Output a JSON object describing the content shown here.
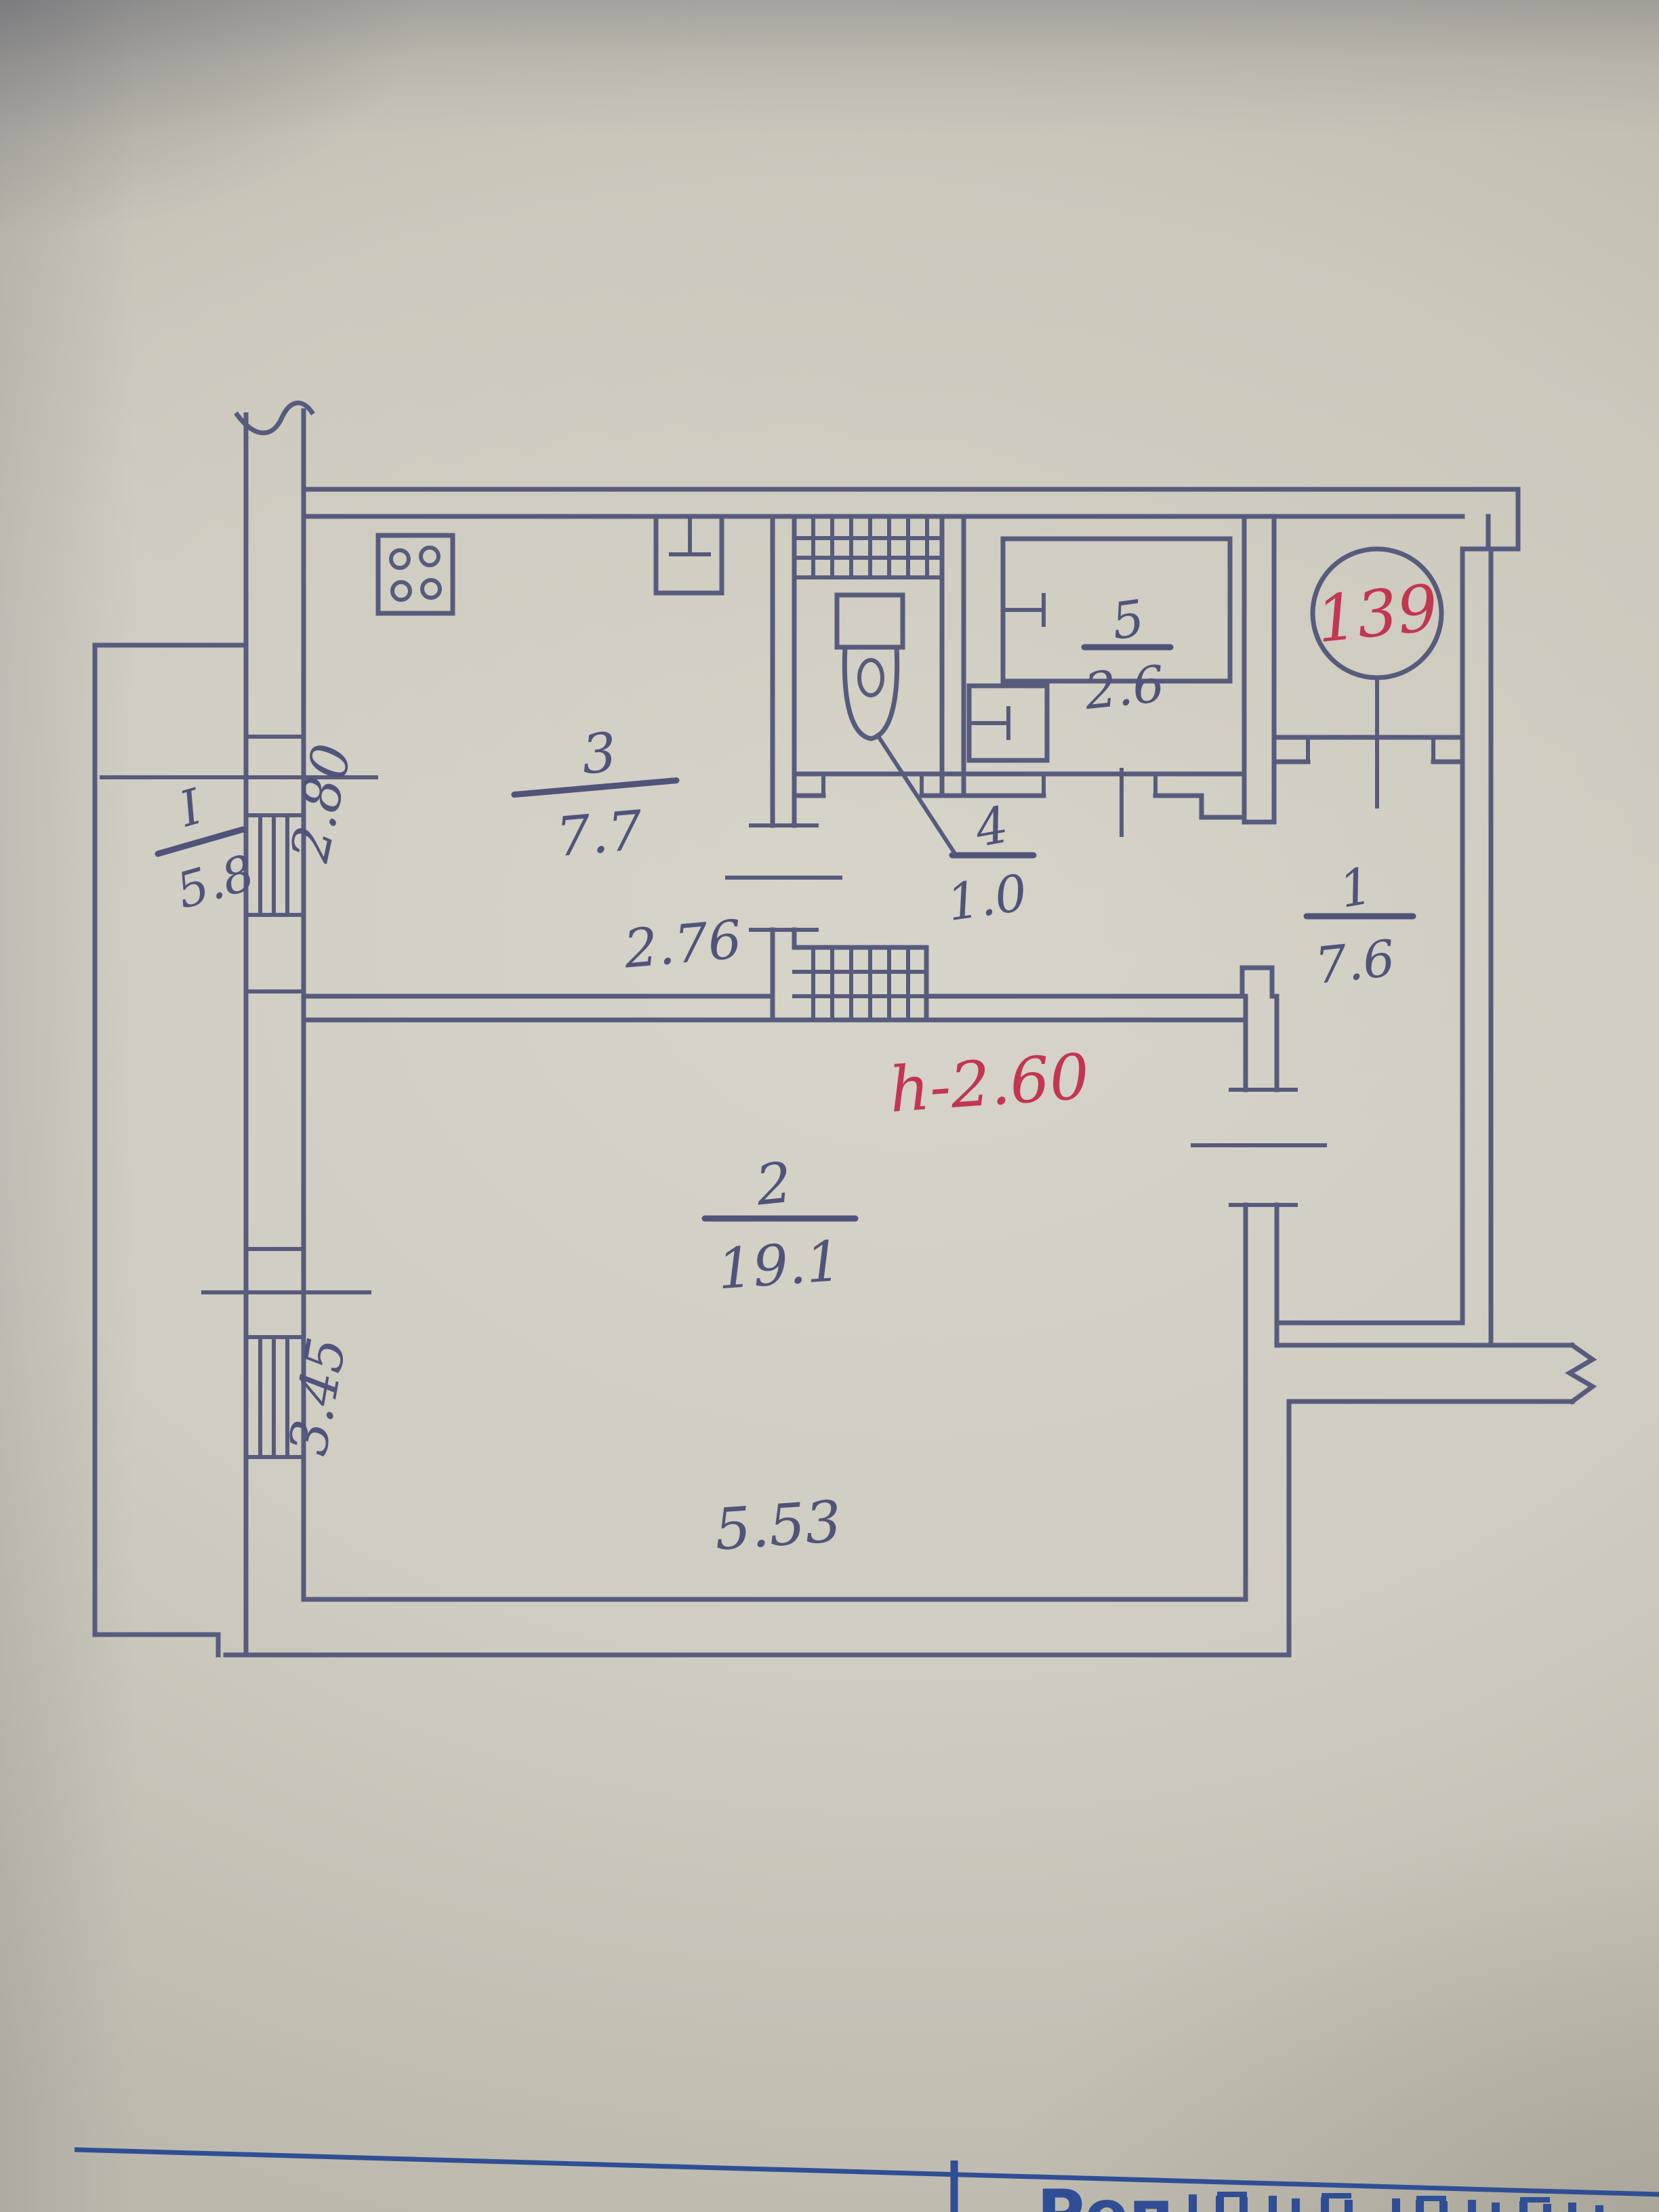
{
  "plan": {
    "rooms": {
      "balcony": {
        "number": "I",
        "area": "5.8"
      },
      "hall": {
        "number": "1",
        "area": "7.6"
      },
      "living": {
        "number": "2",
        "area": "19.1"
      },
      "kitchen": {
        "number": "3",
        "area": "7.7"
      },
      "wc": {
        "number": "4",
        "area": "1.0"
      },
      "bath": {
        "number": "5",
        "area": "2.6"
      }
    },
    "dims": {
      "kitchen_width": "2.76",
      "kitchen_depth": "2.80",
      "living_width": "5.53",
      "living_depth": "3.45"
    },
    "notes": {
      "ceiling_height": "h-2.60",
      "apartment_number": "139"
    },
    "icons": {
      "fixtures": [
        "stove-icon",
        "sink-icon",
        "toilet-icon",
        "bathtub-icon",
        "washbasin-icon"
      ],
      "symbols": [
        "window-hatch",
        "vent-shaft-hatch",
        "wall-break",
        "door-opening",
        "apartment-number-circle"
      ]
    },
    "colors": {
      "ink": "#575b7c",
      "red_ink": "#c23650",
      "stamp_blue": "#2f4e96",
      "paper": "#cfccc1"
    }
  },
  "stamp": {
    "fragment": "Реп"
  }
}
